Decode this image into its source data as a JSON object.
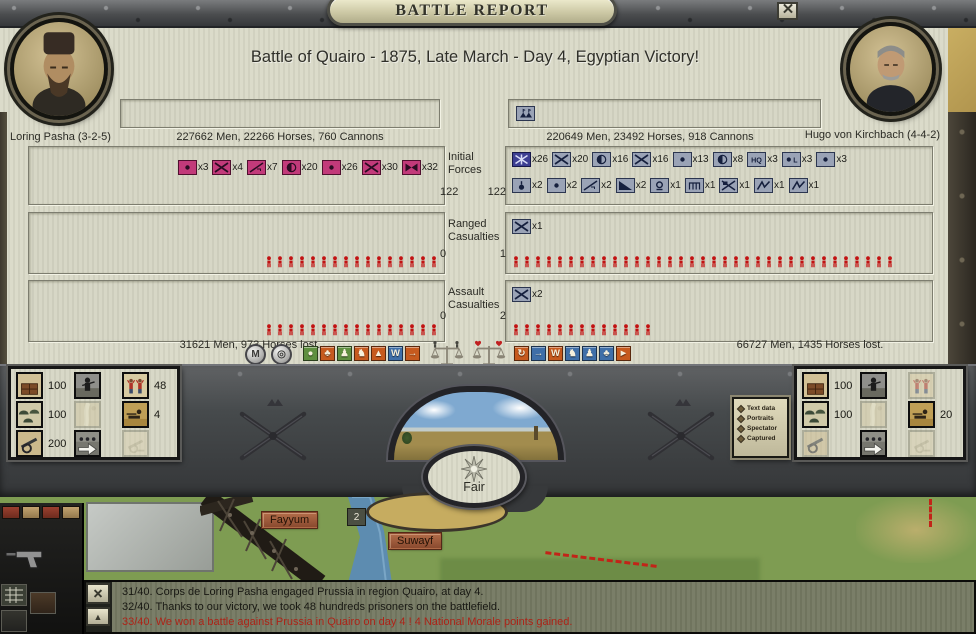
{
  "window": {
    "title": "BATTLE REPORT"
  },
  "battle": {
    "headline": "Battle of Quairo - 1875, Late March - Day 4, Egyptian Victory!"
  },
  "left": {
    "commander": "Loring Pasha (3-2-5)",
    "stats": "227662 Men, 22266 Horses, 760 Cannons",
    "losses": "31621 Men, 973 Horses lost.",
    "color": "#c23a7a"
  },
  "right": {
    "commander": "Hugo von Kirchbach (4-4-2)",
    "stats": "220649 Men, 23492 Horses, 918 Cannons",
    "losses": "66727 Men, 1435 Horses lost.",
    "color": "#9aa3b6"
  },
  "top_boxes": {
    "right_units": [
      {
        "type": "camp"
      }
    ]
  },
  "sections": {
    "initial": {
      "label": "Initial Forces",
      "left_value": "122",
      "right_value": "122",
      "left_units": [
        {
          "type": "dot",
          "count": 3
        },
        {
          "type": "x",
          "count": 4
        },
        {
          "type": "diag-l",
          "count": 7
        },
        {
          "type": "half",
          "count": 20
        },
        {
          "type": "dot",
          "count": 26
        },
        {
          "type": "x",
          "count": 30
        },
        {
          "type": "bowtie",
          "count": 32
        }
      ],
      "right_units_row1": [
        {
          "type": "star-x",
          "count": 26,
          "special": true
        },
        {
          "type": "x",
          "count": 20
        },
        {
          "type": "half",
          "count": 16
        },
        {
          "type": "x",
          "count": 16
        },
        {
          "type": "dot",
          "count": 13
        },
        {
          "type": "half",
          "count": 8
        },
        {
          "type": "hq",
          "count": 3
        },
        {
          "type": "dot-l",
          "count": 3
        },
        {
          "type": "dot",
          "count": 3
        }
      ],
      "right_units_row2": [
        {
          "type": "drop",
          "count": 2
        },
        {
          "type": "dot",
          "count": 2
        },
        {
          "type": "diag-l",
          "count": 2
        },
        {
          "type": "filled-diag",
          "count": 2
        },
        {
          "type": "lamp",
          "count": 1
        },
        {
          "type": "bridge",
          "count": 1
        },
        {
          "type": "x-flag",
          "count": 1
        },
        {
          "type": "lightning",
          "count": 1
        },
        {
          "type": "lightning",
          "count": 1
        }
      ]
    },
    "ranged": {
      "label": "Ranged Casualties",
      "left_value": "0",
      "right_value": "1",
      "right_units": [
        {
          "type": "x",
          "count": 1
        }
      ],
      "left_figures": 16,
      "right_figures": 35
    },
    "assault": {
      "label": "Assault Casualties",
      "left_value": "0",
      "right_value": "2",
      "right_units": [
        {
          "type": "x",
          "count": 2
        }
      ],
      "left_figures": 16,
      "right_figures": 13
    }
  },
  "toolbar": {
    "round_buttons": [
      {
        "name": "map-toggle",
        "glyph": "M"
      },
      {
        "name": "target-toggle",
        "glyph": "◎"
      }
    ],
    "left_icons": [
      {
        "name": "cohesion-stat",
        "glyph": "●",
        "bg": "#5f8f3f"
      },
      {
        "name": "morale-stat",
        "glyph": "♣",
        "bg": "#c65a1e"
      },
      {
        "name": "infantry-stat",
        "glyph": "♟",
        "bg": "#5f8f3f"
      },
      {
        "name": "cavalry-stat",
        "glyph": "♞",
        "bg": "#c65a1e"
      },
      {
        "name": "supply-stat",
        "glyph": "▲",
        "bg": "#c65a1e"
      },
      {
        "name": "men-stat",
        "glyph": "W",
        "bg": "#3f6fa8"
      },
      {
        "name": "advance-stat",
        "glyph": "→",
        "bg": "#c65a1e"
      }
    ],
    "scales": [
      {
        "name": "men-balance"
      },
      {
        "name": "morale-balance"
      }
    ],
    "right_icons": [
      {
        "name": "retreat-stat",
        "glyph": "↻",
        "bg": "#c65a1e"
      },
      {
        "name": "advance-stat",
        "glyph": "→",
        "bg": "#3f6fa8"
      },
      {
        "name": "men-stat",
        "glyph": "W",
        "bg": "#c65a1e"
      },
      {
        "name": "cavalry-stat",
        "glyph": "♞",
        "bg": "#3f6fa8"
      },
      {
        "name": "infantry-stat",
        "glyph": "♟",
        "bg": "#3f6fa8"
      },
      {
        "name": "morale-stat",
        "glyph": "♣",
        "bg": "#3f6fa8"
      },
      {
        "name": "pursuit-stat",
        "glyph": "►",
        "bg": "#c65a1e"
      }
    ]
  },
  "weather": {
    "label": "Fair"
  },
  "side_buttons": [
    {
      "label": "Text data"
    },
    {
      "label": "Portraits"
    },
    {
      "label": "Spectator"
    },
    {
      "label": "Captured"
    }
  ],
  "left_panel": {
    "tiles": [
      {
        "kind": "supplies",
        "value": "100",
        "active": true
      },
      {
        "kind": "soldier",
        "value": "",
        "active": true
      },
      {
        "kind": "prisoners",
        "value": "48",
        "active": true
      },
      {
        "kind": "tents",
        "value": "100",
        "active": true
      },
      {
        "kind": "road",
        "value": "",
        "active": false
      },
      {
        "kind": "skirmisher",
        "value": "4",
        "active": true
      },
      {
        "kind": "cannon",
        "value": "200",
        "active": true
      },
      {
        "kind": "advance",
        "value": "",
        "active": true
      },
      {
        "kind": "artillery",
        "value": "",
        "active": false
      }
    ]
  },
  "right_panel": {
    "tiles": [
      {
        "kind": "supplies",
        "value": "100",
        "active": true
      },
      {
        "kind": "soldier",
        "value": "",
        "active": true
      },
      {
        "kind": "prisoners",
        "value": "",
        "active": false
      },
      {
        "kind": "tents",
        "value": "100",
        "active": true
      },
      {
        "kind": "road",
        "value": "",
        "active": false
      },
      {
        "kind": "skirmisher",
        "value": "20",
        "active": true
      },
      {
        "kind": "cannon",
        "value": "",
        "active": false
      },
      {
        "kind": "advance",
        "value": "",
        "active": true
      },
      {
        "kind": "artillery",
        "value": "",
        "active": false
      }
    ]
  },
  "map": {
    "labels": [
      {
        "name": "Fayyum"
      },
      {
        "name": "Suwayf"
      }
    ],
    "unit_badge": "2"
  },
  "log": {
    "messages": [
      {
        "text": "31/40.  Corps de Loring Pasha engaged Prussia in region Quairo, at day 4.",
        "emphasis": false
      },
      {
        "text": "32/40.  Thanks to our victory, we took 48 hundreds prisoners on the battlefield.",
        "emphasis": false
      },
      {
        "text": "33/40.  We won a battle against Prussia in Quairo on day 4 ! 4 National Morale points gained.",
        "emphasis": true
      }
    ]
  }
}
